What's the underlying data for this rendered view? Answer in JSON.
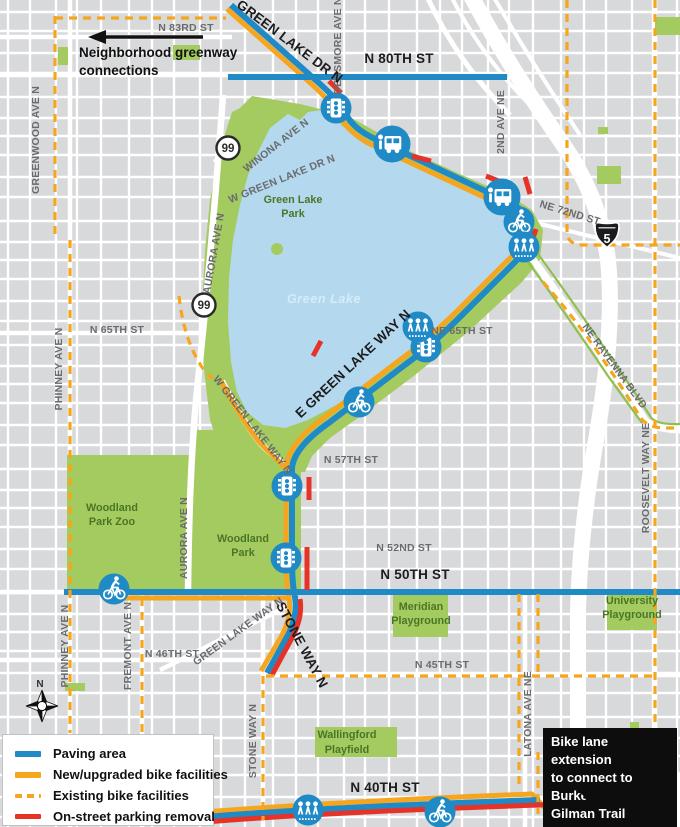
{
  "map_region": "Green Lake / Wallingford",
  "colors": {
    "paving_blue": "#1f8ac6",
    "bike_orange": "#f6a51e",
    "parking_removal_red": "#e73228",
    "park_green": "#a4cb5f",
    "water_blue": "#b4d9ee",
    "background_gray": "#d8d9da"
  },
  "legend": {
    "items": [
      {
        "label": "Paving area",
        "swatch": "solid-blue"
      },
      {
        "label": "New/upgraded bike facilities",
        "swatch": "solid-orange"
      },
      {
        "label": "Existing bike facilities",
        "swatch": "dashed-orange"
      },
      {
        "label": "On-street parking removal",
        "swatch": "solid-red"
      }
    ]
  },
  "annotations": {
    "greenway_note": {
      "lines": [
        "Neighborhood greenway",
        "connections"
      ]
    },
    "callout": {
      "lines": [
        "Bike lane extension",
        "to connect to Burke",
        "Gilman Trail"
      ]
    }
  },
  "shields": [
    {
      "type": "state-route-circle",
      "text": "99"
    },
    {
      "type": "state-route-circle",
      "text": "99"
    },
    {
      "type": "interstate",
      "text": "5"
    }
  ],
  "compass": {
    "label": "N"
  },
  "icons": {
    "traffic_signal": "signal-icon",
    "bus": "bus-icon",
    "bike": "bike-icon",
    "pedestrian_crossing": "pedestrians-icon"
  },
  "labels": {
    "streets_gray": [
      "N 83RD ST",
      "DENSMORE AVE N",
      "2ND AVE NE",
      "NE 72ND ST",
      "WINONA AVE N",
      "W GREEN LAKE DR N",
      "GREENWOOD AVE N",
      "AURORA AVE N",
      "N 65TH ST",
      "PHINNEY AVE N",
      "NE 65TH ST",
      "NE RAVENNA BLVD",
      "ROOSEVELT WAY NE",
      "N 57TH ST",
      "N 52ND ST",
      "AURORA AVE N",
      "PHINNEY AVE N",
      "FREMONT AVE N",
      "GREEN LAKE WAY N",
      "N 46TH ST",
      "STONE WAY N",
      "N 45TH ST",
      "LATONA AVE NE",
      "W GREEN LAKE WAY N"
    ],
    "streets_black": [
      "GREEN LAKE DR N",
      "N 80TH ST",
      "E GREEN LAKE WAY N",
      "N 50TH ST",
      "STONE WAY N",
      "N 40TH ST"
    ],
    "parks": [
      [
        "Green Lake",
        "Park"
      ],
      [
        "Woodland",
        "Park Zoo"
      ],
      [
        "Woodland",
        "Park"
      ],
      [
        "Meridian",
        "Playground"
      ],
      [
        "University",
        "Playground"
      ],
      [
        "Wallingford",
        "Playfield"
      ]
    ],
    "water": "Green Lake"
  }
}
